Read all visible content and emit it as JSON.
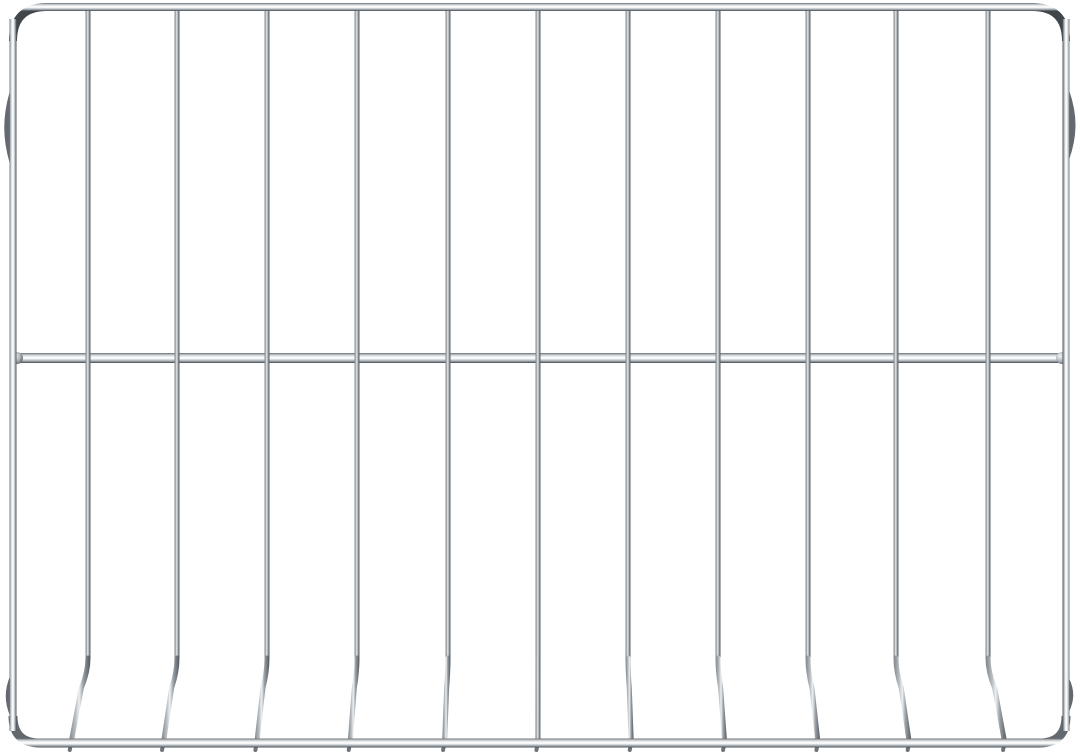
{
  "photo": {
    "subject": "chrome-wire-oven-rack",
    "background_color": "#ffffff",
    "canvas": {
      "width": 1080,
      "height": 755
    },
    "colors": {
      "bar_stops": [
        [
          "0",
          "#63696e"
        ],
        [
          "0.18",
          "#c3c8cc"
        ],
        [
          "0.40",
          "#f6f8f9"
        ],
        [
          "0.52",
          "#ffffff"
        ],
        [
          "0.68",
          "#cfd4d8"
        ],
        [
          "0.85",
          "#8f969c"
        ],
        [
          "1",
          "#41464b"
        ]
      ],
      "wire_stops": [
        [
          "0",
          "#7d8388"
        ],
        [
          "0.30",
          "#b7bcc1"
        ],
        [
          "0.48",
          "#eef0f2"
        ],
        [
          "0.66",
          "#9aa1a6"
        ],
        [
          "1",
          "#51575c"
        ]
      ],
      "weld_stops": [
        [
          "0",
          "#f5f6f7"
        ],
        [
          "0.55",
          "#aeb4b9"
        ],
        [
          "1",
          "#5b6065"
        ]
      ],
      "nub_color": "#6e747a",
      "tip_bump_color": "#7a8085"
    },
    "frame": {
      "left_x": 13,
      "right_x": 1066,
      "top_y": 7,
      "bottom_y": 743,
      "corner_radius_top": 34,
      "corner_radius_bottom": 27,
      "top_thickness": 8,
      "bottom_thickness": 9,
      "side_thickness": 7,
      "stop_bumps": [
        {
          "side": "left",
          "y1": 93,
          "y2": 162,
          "depth": 7
        },
        {
          "side": "right",
          "y1": 92,
          "y2": 158,
          "depth": 8
        },
        {
          "side": "left",
          "y1": 678,
          "y2": 714,
          "depth": 5
        },
        {
          "side": "right",
          "y1": 680,
          "y2": 710,
          "depth": 5
        }
      ]
    },
    "crossbar": {
      "y": 358,
      "thickness": 10,
      "x1": 13,
      "x2": 1066,
      "weld_radius": 6
    },
    "wires": {
      "xs": [
        88,
        177,
        267,
        357,
        448,
        538,
        628,
        718,
        808,
        896,
        988
      ],
      "thickness": 5,
      "top_y": 10,
      "kink_y": 658,
      "bottom_y": 742,
      "max_splay": 10,
      "tip_bump_radius": 3,
      "foot_nub_length": 8
    }
  }
}
